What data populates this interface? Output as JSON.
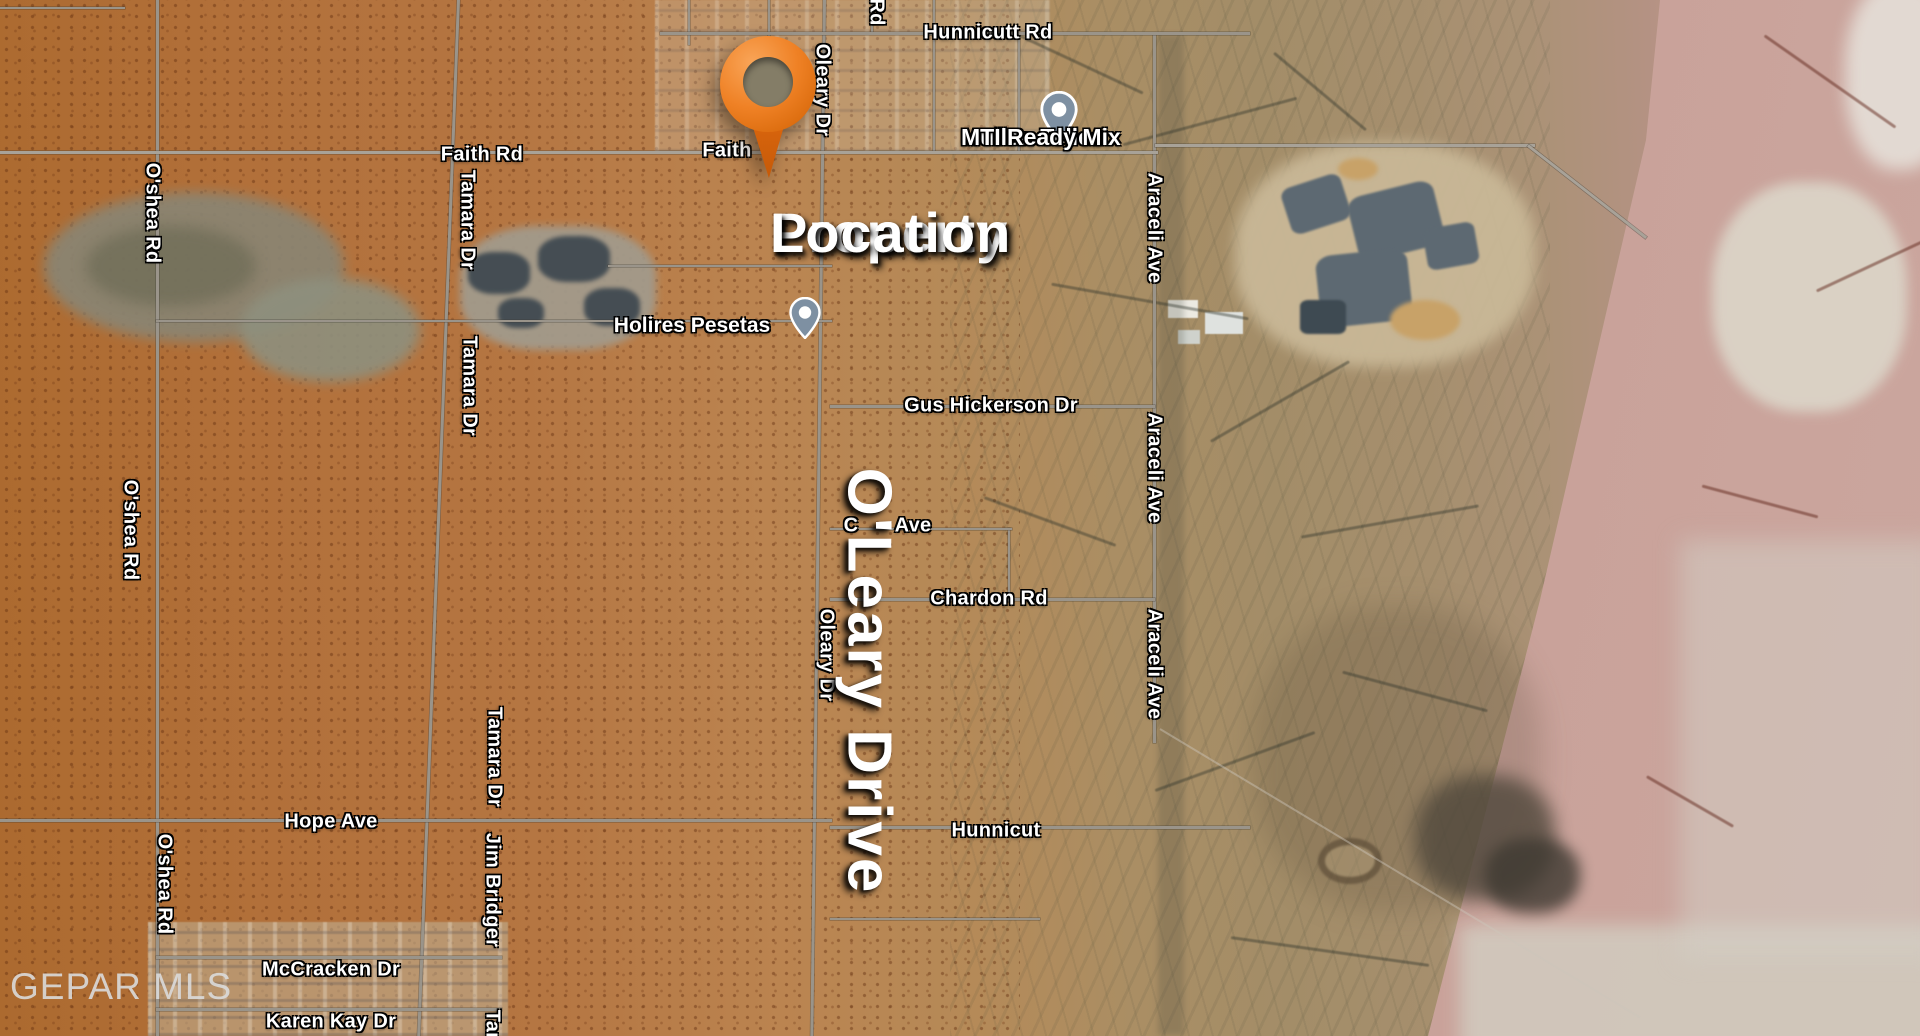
{
  "map": {
    "type": "satellite",
    "watermark": "GEPAR MLS",
    "annotations": {
      "property": {
        "line1": "Property",
        "line2": "Location"
      },
      "street": "O'Leary Drive"
    },
    "businesses": {
      "mullen": {
        "line1": "Mullen Telles",
        "line2": "MTI Ready Mix"
      },
      "pesetas": {
        "name": "Holires Pesetas"
      }
    },
    "road_labels": {
      "horizontal": [
        {
          "text": "Hunnicutt Rd",
          "x": 988,
          "y": 33
        },
        {
          "text": "Faith Rd",
          "x": 482,
          "y": 155
        },
        {
          "text": "Faith",
          "x": 727,
          "y": 151
        },
        {
          "text": "Gus Hickerson Dr",
          "x": 991,
          "y": 406
        },
        {
          "text": "C",
          "x": 851,
          "y": 526
        },
        {
          "text": "Ave",
          "x": 913,
          "y": 526
        },
        {
          "text": "Chardon Rd",
          "x": 989,
          "y": 599
        },
        {
          "text": "Hope Ave",
          "x": 331,
          "y": 822
        },
        {
          "text": "Hunnicut",
          "x": 996,
          "y": 831
        },
        {
          "text": "McCracken Dr",
          "x": 331,
          "y": 970
        },
        {
          "text": "Karen Kay Dr",
          "x": 331,
          "y": 1022
        }
      ],
      "vertical": [
        {
          "text": "Rd",
          "x": 876,
          "y": 12
        },
        {
          "text": "Oleary Dr",
          "x": 822,
          "y": 90
        },
        {
          "text": "O'shea Rd",
          "x": 152,
          "y": 213
        },
        {
          "text": "O'shea Rd",
          "x": 130,
          "y": 530
        },
        {
          "text": "O'shea Rd",
          "x": 164,
          "y": 884
        },
        {
          "text": "Tamara Dr",
          "x": 467,
          "y": 220
        },
        {
          "text": "Tamara Dr",
          "x": 469,
          "y": 386
        },
        {
          "text": "Tamara Dr",
          "x": 494,
          "y": 757
        },
        {
          "text": "Jim Bridger",
          "x": 492,
          "y": 890
        },
        {
          "text": "Tam",
          "x": 492,
          "y": 1030
        },
        {
          "text": "Araceli Ave",
          "x": 1154,
          "y": 228
        },
        {
          "text": "Araceli Ave",
          "x": 1154,
          "y": 468
        },
        {
          "text": "Araceli Ave",
          "x": 1154,
          "y": 664
        },
        {
          "text": "Oleary Dr",
          "x": 826,
          "y": 655
        }
      ]
    },
    "colors": {
      "property_pin_orange": "#ee7d1f",
      "business_pin_slate": "#7e90a2",
      "desert_orange": "#b3713a",
      "scrub_tan": "#a68f6e",
      "pink_terrain": "#c79a90",
      "quarry_slate": "#5d6972",
      "label_text": "#ffffff",
      "watermark_grey": "#dadada"
    }
  }
}
